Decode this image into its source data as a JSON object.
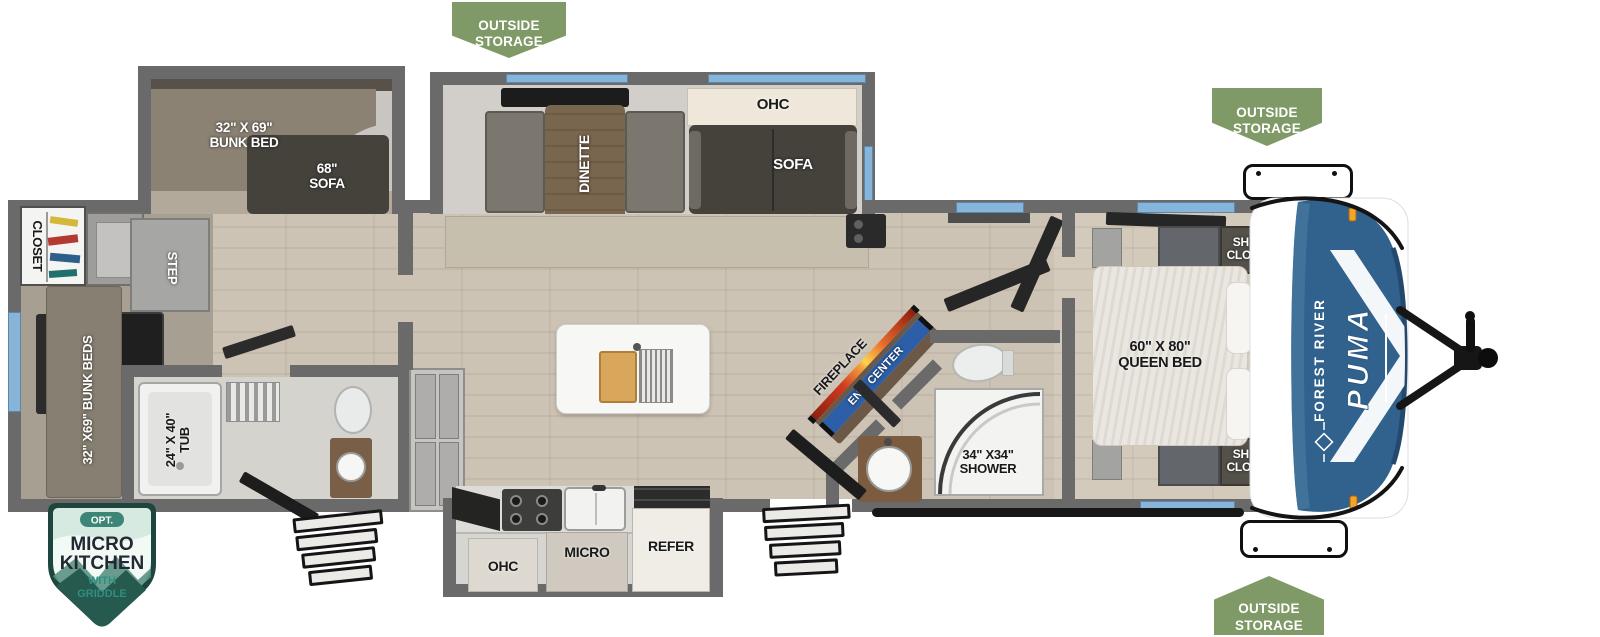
{
  "colors": {
    "wall_gray": "#6a6a6a",
    "window_blue": "#86b5d9",
    "badge_green": "#7f9a66",
    "cap_blue": "#31618d",
    "ent_center_blue": "#2d5fa8",
    "fireplace_orange": "#e8682b",
    "micro_badge_dark_teal": "#1e453e",
    "micro_badge_teal": "#2c8f82",
    "marker_light_orange": "#f6a427"
  },
  "badges": {
    "outside_storage": "OUTSIDE\nSTORAGE",
    "micro_kitchen": {
      "opt": "OPT.",
      "title_line1": "MICRO",
      "title_line2": "KITCHEN",
      "sub_line1": "WITH",
      "sub_line2": "GRIDDLE"
    }
  },
  "brand": {
    "make": "FOREST RIVER",
    "model": "PUMA"
  },
  "rooms": {
    "bunk_slide": {
      "bunk_bed": "32\" X 69\"\nBUNK BED",
      "sofa": "68\"\nSOFA"
    },
    "rear_bunk_room": {
      "closet": "CLOSET",
      "step": "STEP",
      "bunk_beds": "32\" X69\" BUNK BEDS"
    },
    "rear_bath": {
      "tub": "24\" X 40\"\nTUB"
    },
    "dinette_slide": {
      "dinette": "DINETTE",
      "ohc": "OHC",
      "sofa": "SOFA"
    },
    "kitchen": {
      "ohc": "OHC",
      "micro": "MICRO",
      "refer": "REFER"
    },
    "living": {
      "fireplace": "FIREPLACE",
      "ent_center": "ENT. CENTER"
    },
    "main_bath": {
      "shower": "34\" X34\"\nSHOWER"
    },
    "bedroom": {
      "queen_bed": "60\" X 80\"\nQUEEN BED",
      "shirt_closet_top": "SHIRT\nCLOSET",
      "shirt_closet_bottom": "SHIRT\nCLOSET",
      "ohc": "OHC"
    }
  }
}
